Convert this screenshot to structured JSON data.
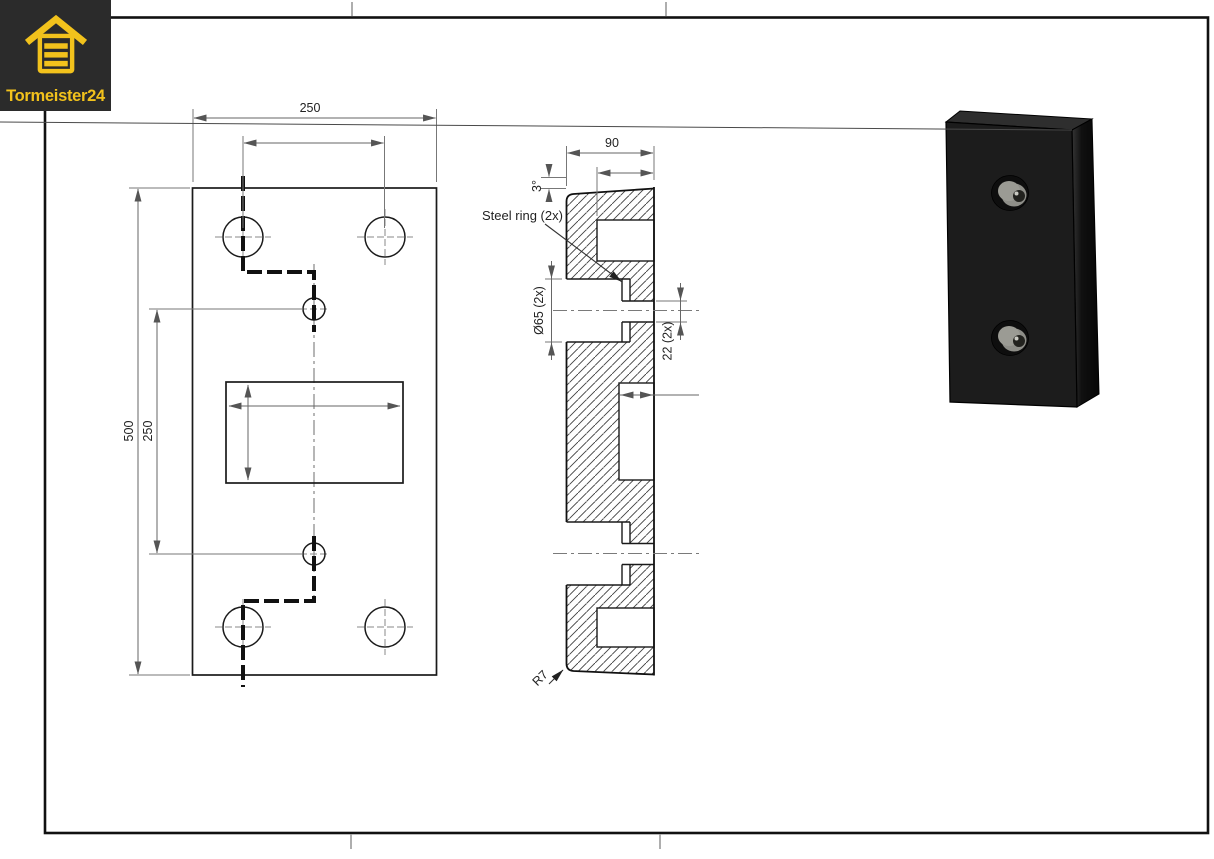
{
  "logo": {
    "brand": "Tormeister24",
    "icon": "garage-door-icon"
  },
  "front_view": {
    "dim_width_top": "250",
    "dim_height": "500",
    "dim_hole_spacing": "250"
  },
  "section_view": {
    "dim_depth": "90",
    "dim_angle": "3°",
    "label_steel_ring": "Steel ring (2x)",
    "dim_counterbore_dia": "Ø65 (2x)",
    "dim_hole_dia": "22 (2x)",
    "dim_radius": "R7"
  },
  "colors": {
    "accent": "#F2C21C",
    "logo_bg": "#2B2B2B",
    "object_line": "#1A1A1A",
    "dim_line": "#6E6E6E",
    "render_body": "#1C1C1C",
    "steel_ring_gray": "#8E8E88"
  }
}
